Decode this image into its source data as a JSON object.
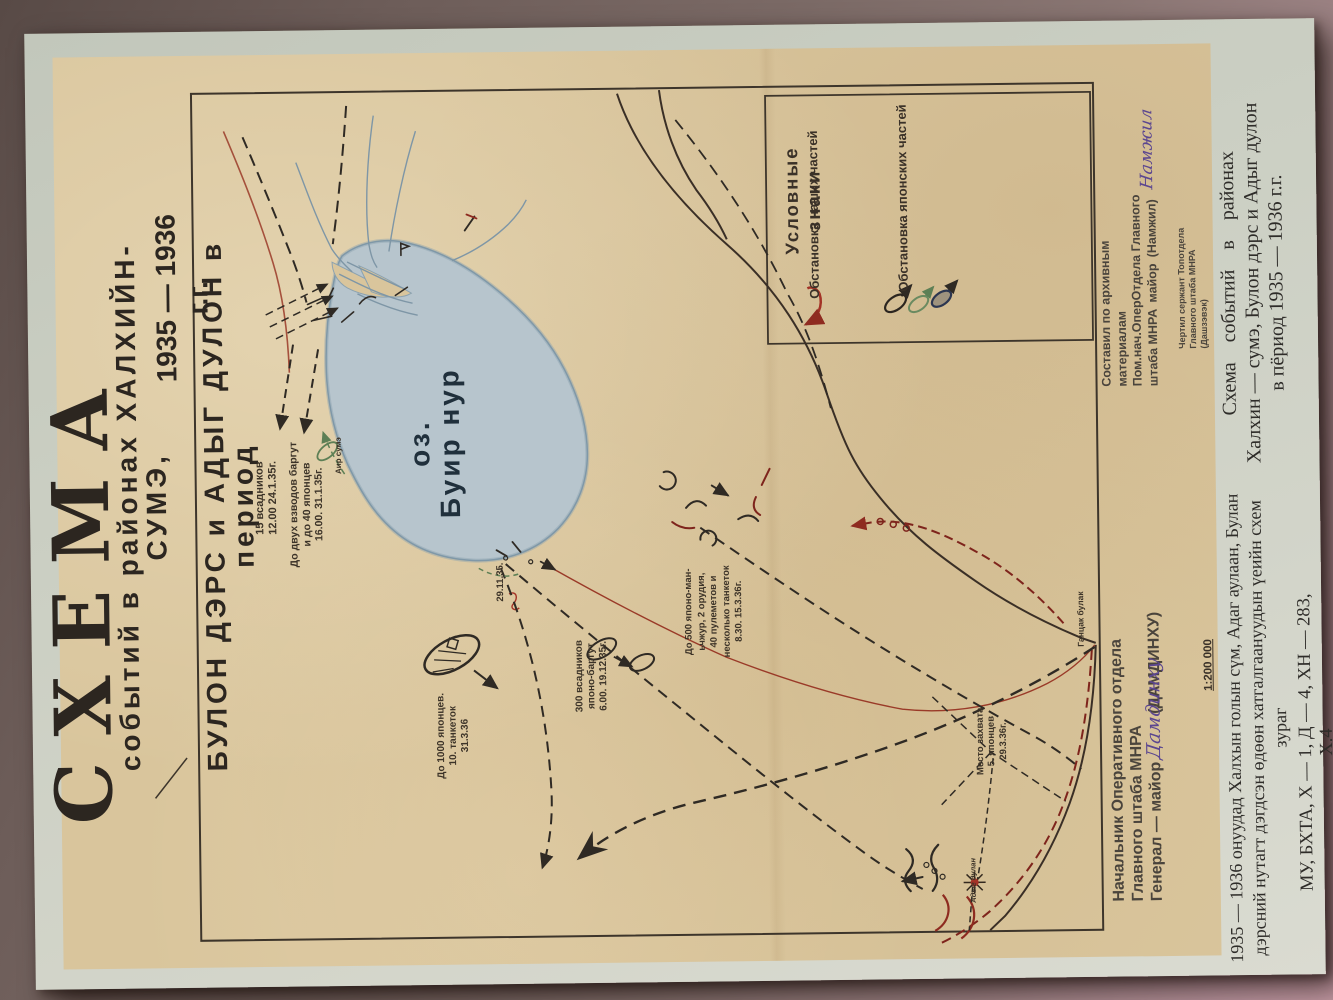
{
  "photo": {
    "background_color": "#7b6a66",
    "page_color": "#cbcfc3",
    "map_paper_color": "#d9c59c",
    "our_forces_color": "#a33226",
    "japanese_forces_color": "#2f2a24",
    "water_color": "#b7c5cd"
  },
  "map": {
    "title": "СХЕМА",
    "subtitle_line_1": "событий в районах ХАЛХИЙН-СУМЭ,",
    "subtitle_line_2": "БУЛОН ДЭРС и АДЫГ ДУЛОН в период",
    "subtitle_line_3": "1935 — 1936 г.г.",
    "scale": "1:200 000",
    "lake_label": [
      "оз.",
      "Буир нур"
    ],
    "legend": {
      "title": "Условные знаки",
      "items": [
        {
          "label": "Обстановка наших частей",
          "symbol": "red-arrow"
        },
        {
          "label": "Обстановка японских частей",
          "symbol": "unit-ovals"
        }
      ]
    },
    "annotations": [
      {
        "name": "15-riders",
        "lines": [
          "15 всадников",
          "12.00 24.1.35г."
        ]
      },
      {
        "name": "two-platoons",
        "lines": [
          "До двух взводов баргут",
          "и до 40 японцев",
          "16.00. 31.1.35г."
        ]
      },
      {
        "name": "date-29-11-35",
        "lines": [
          "29.11.35."
        ]
      },
      {
        "name": "300-riders",
        "lines": [
          "300 всадников",
          "японо-баргут",
          "6.00. 19.12.35г."
        ]
      },
      {
        "name": "1000-japanese",
        "lines": [
          "До 1000 японцев.",
          "10. танкеток",
          "31.3.36"
        ]
      },
      {
        "name": "500-japanese",
        "lines": [
          "До 500 японо-ман-",
          "ьчжур, 2 орудия,",
          "40 пулеметов и",
          "несколько танкеток",
          "8.30. 15.3.36г."
        ]
      },
      {
        "name": "capture-site",
        "lines": [
          "Место захвата",
          "5. японцев",
          "29.3.36г."
        ]
      },
      {
        "name": "gantsak-bulak",
        "lines": [
          "Ганцак булак"
        ]
      },
      {
        "name": "air-sume",
        "lines": [
          "Аир сумэ"
        ]
      },
      {
        "name": "adyg-dulan",
        "lines": [
          "Адыг дулан"
        ]
      }
    ],
    "signatures": {
      "chief_block": [
        "Начальник Оперативного отдела",
        "Главного штаба МНРА",
        "Генерал — майор   (ДАМДИНХУ)"
      ],
      "chief_autograph": "Дамдинху",
      "compiler_block": [
        "Составил по архивным",
        "материалам",
        "Пом.нач.ОперОтдела Главного",
        "штаба МНРА майор (Намжил)"
      ],
      "compiler_autograph": "Намжил",
      "draftsman_block": [
        "Чертил сержант Топотдела",
        "Главного штаба МНРА (Дашзэвэк)"
      ]
    }
  },
  "caption": {
    "russian": [
      "Схема событий в районах",
      "Халхин — сумэ, Булон дэрс и Адыг дулон",
      "в пёриод 1935 — 1936 г.г."
    ],
    "mongolian": [
      "1935 — 1936 онуудад Халхын голын сүм, Адаг аулаан, Булан",
      "дэрсний нутагт дэгдсэн өдөөн хатгалгаануудын үеийн схем",
      "зураг"
    ],
    "archive_ref": "МУ, БХТА, Х — 1, Д — 4, ХН — 283, Х.4"
  }
}
